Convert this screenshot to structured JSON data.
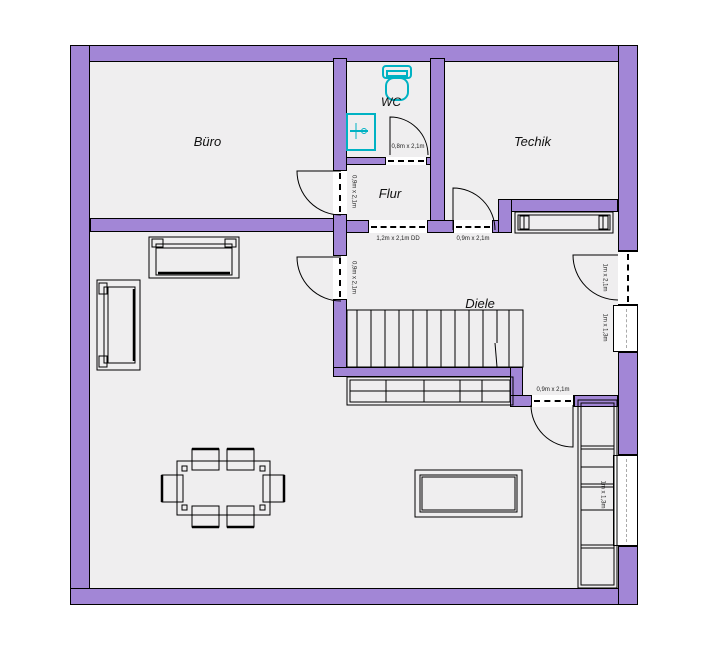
{
  "colors": {
    "wall": "#a286d6",
    "floor": "#efeeef",
    "fixture": "#00b2c3",
    "line": "#000000"
  },
  "rooms": [
    {
      "id": "buero",
      "label": "Büro"
    },
    {
      "id": "wc",
      "label": "WC"
    },
    {
      "id": "flur",
      "label": "Flur"
    },
    {
      "id": "techik",
      "label": "Techik"
    },
    {
      "id": "diele",
      "label": "Diele"
    }
  ],
  "annotations": {
    "wc_door": "0,8m x 2,1m",
    "flur_double_door": "1,2m x 2,1m DD",
    "techik_door": "0,9m x 2,1m",
    "buero_door": "0,9m x 2,1m",
    "living_door": "0,9m x 2,1m",
    "diele_door": "0,9m x 2,1m",
    "right_door": "1m x 2,1m",
    "right_window": "1m x 1,3m",
    "shelf_window": "1m x 1,3m"
  }
}
